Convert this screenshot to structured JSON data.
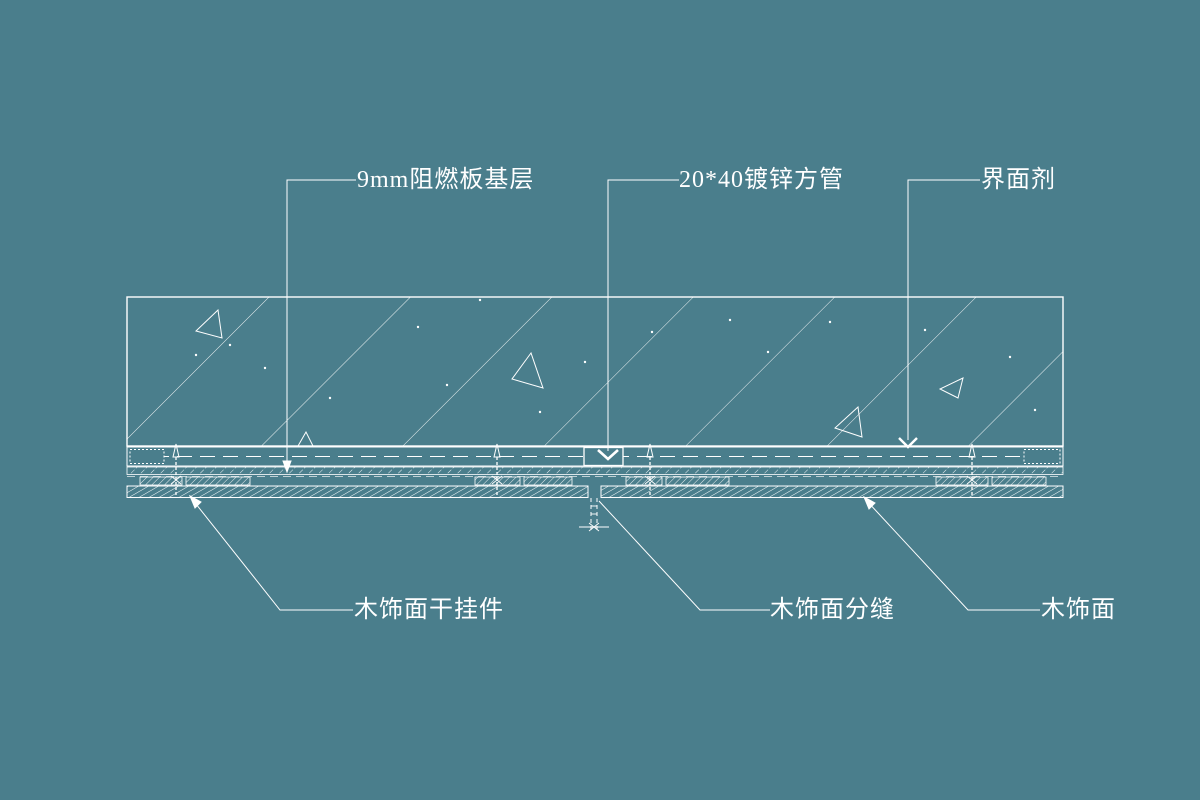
{
  "drawing": {
    "background_color": "#4a7e8c",
    "line_color": "#ffffff",
    "annotations": {
      "top": [
        {
          "label": "9mm阻燃板基层"
        },
        {
          "label": "20*40镀锌方管"
        },
        {
          "label": "界面剂"
        }
      ],
      "bottom": [
        {
          "label": "木饰面干挂件"
        },
        {
          "label": "木饰面分缝"
        },
        {
          "label": "木饰面"
        }
      ]
    }
  }
}
